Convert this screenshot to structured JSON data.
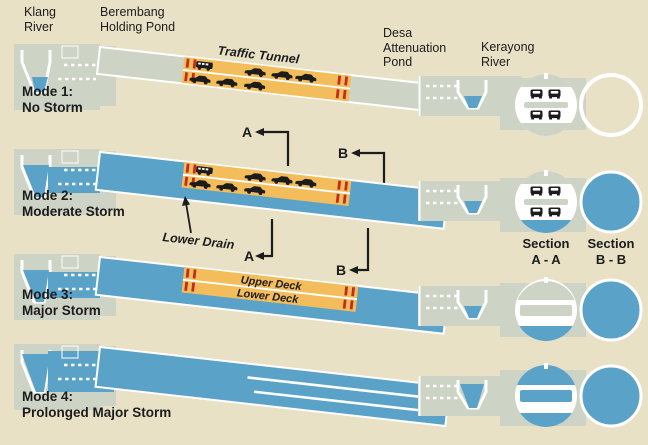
{
  "colors": {
    "background": "#e9e1c6",
    "structure_gray": "#cdd3c5",
    "water_blue": "#5aa2c8",
    "deck_orange": "#f3bd5c",
    "marker_red": "#c32b1d",
    "ink": "#1c1c1c"
  },
  "header_labels": {
    "klang_river": "Klang River",
    "berembang": "Berembang Holding Pond",
    "desa": "Desa Attenuation Pond",
    "kerayong": "Kerayong River"
  },
  "modes": [
    {
      "name": "Mode 1:",
      "desc": "No Storm"
    },
    {
      "name": "Mode 2:",
      "desc": "Moderate Storm"
    },
    {
      "name": "Mode 3:",
      "desc": "Major Storm"
    },
    {
      "name": "Mode 4:",
      "desc": "Prolonged Major Storm"
    }
  ],
  "annotations": {
    "traffic_tunnel": "Traffic Tunnel",
    "lower_drain": "Lower Drain",
    "upper_deck": "Upper Deck",
    "lower_deck": "Lower Deck",
    "section_marker_a": "A",
    "section_marker_b": "B"
  },
  "sections": {
    "a": {
      "line1": "Section",
      "line2": "A - A"
    },
    "b": {
      "line1": "Section",
      "line2": "B - B"
    }
  }
}
